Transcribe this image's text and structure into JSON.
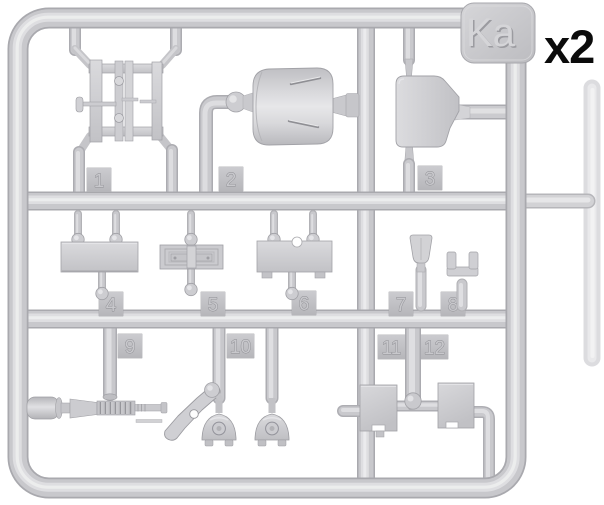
{
  "sprue": {
    "label": "Ka",
    "quantity_label": "x2",
    "part_numbers": [
      "1",
      "2",
      "3",
      "4",
      "5",
      "6",
      "7",
      "8",
      "9",
      "10",
      "11",
      "12"
    ]
  },
  "colors": {
    "background": "#ffffff",
    "plastic_base": "#c8c8cc",
    "plastic_edge": "#a9a9ae",
    "plastic_highlight": "#dedee1",
    "tag_face": "#c3c3c7",
    "quantity_text": "#0b0b0b"
  }
}
